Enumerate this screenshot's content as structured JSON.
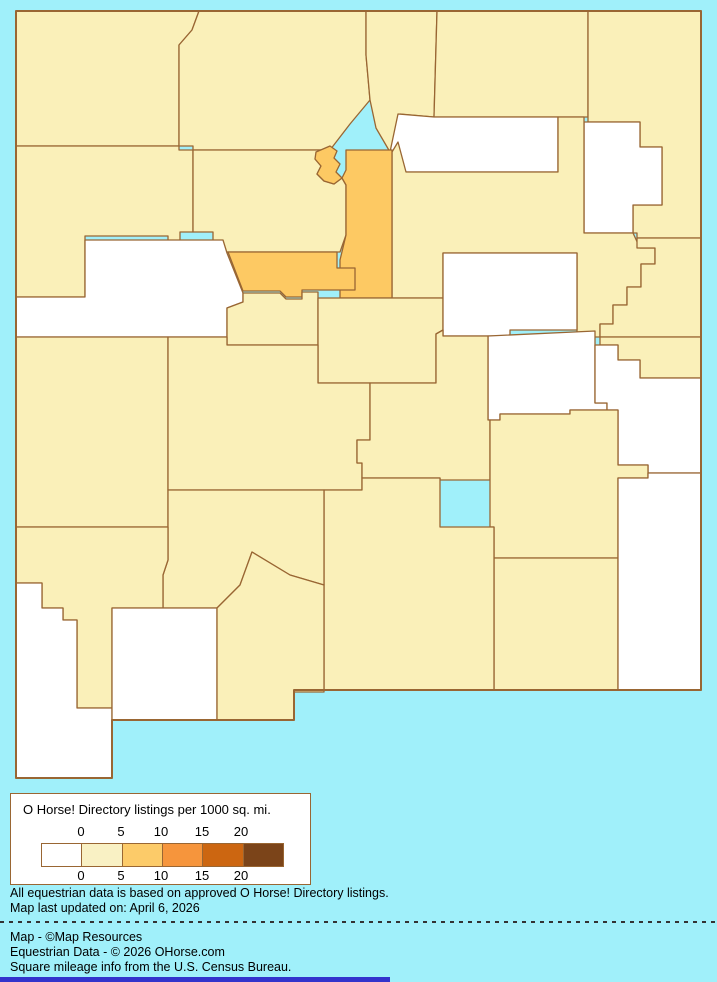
{
  "page": {
    "background_color": "#A0F0FA",
    "bottom_bar_color": "#3333CC"
  },
  "map": {
    "region": "New Mexico counties choropleth",
    "border_color": "#996633",
    "fills": {
      "white": "#FFFFFF",
      "pale": "#FAF0B9",
      "orange": "#FDC963"
    },
    "state_outline": "M16,11 L701,11 L701,690 L294,690 L294,720 L112,720 L112,778 L16,778 Z",
    "counties": [
      {
        "name": "san-juan",
        "category": "pale",
        "d": "M16,11 L199,11 L192,30 L179,45 L179,146 L16,146 Z"
      },
      {
        "name": "rio-arriba",
        "category": "pale",
        "d": "M199,11 L366,11 L366,55 L370,100 L350,124 L330,150 L193,150 L193,146 L179,146 L179,45 L192,30 Z"
      },
      {
        "name": "taos",
        "category": "pale",
        "d": "M366,11 L437,11 L434,117 L400,114 L396,142 L390,152 L376,128 L370,100 L366,55 Z"
      },
      {
        "name": "colfax",
        "category": "pale",
        "d": "M437,11 L588,11 L588,117 L434,117 Z"
      },
      {
        "name": "union",
        "category": "pale",
        "d": "M588,11 L701,11 L701,238 L637,238 L637,233 L633,233 L633,205 L662,205 L662,147 L640,147 L640,122 L588,122 Z"
      },
      {
        "name": "mora",
        "category": "white",
        "d": "M398,114 L434,117 L558,117 L558,172 L406,172 L390,152 Z"
      },
      {
        "name": "harding",
        "category": "white",
        "d": "M584,122 L640,122 L640,147 L662,147 L662,205 L633,205 L633,233 L584,233 Z"
      },
      {
        "name": "san-miguel",
        "category": "pale",
        "d": "M392,152 L398,142 L406,172 L558,172 L558,117 L584,117 L584,233 L633,233 L640,248 L655,248 L655,264 L641,264 L641,287 L627,287 L627,305 L613,305 L613,324 L600,324 L600,337 L577,337 L577,253 L443,253 L443,298 L392,298 Z"
      },
      {
        "name": "quay",
        "category": "pale",
        "d": "M637,238 L701,238 L701,337 L600,337 L600,324 L613,324 L613,305 L627,305 L627,287 L641,287 L641,264 L655,264 L655,248 L637,248 Z"
      },
      {
        "name": "mckinley",
        "category": "pale",
        "d": "M16,146 L179,146 L179,150 L193,150 L193,232 L180,232 L180,242 L168,242 L168,236 L85,236 L85,297 L16,297 Z"
      },
      {
        "name": "sandoval",
        "category": "pale",
        "d": "M193,150 L330,150 L322,157 L315,159 L321,166 L317,174 L324,181 L334,184 L342,178 L346,185 L346,235 L340,252 L213,252 L213,232 L193,232 Z"
      },
      {
        "name": "los-alamos",
        "category": "orange",
        "d": "M316,152 L330,146 L337,151 L334,158 L340,164 L336,172 L342,178 L334,184 L324,181 L317,174 L321,166 L315,159 Z"
      },
      {
        "name": "santa-fe",
        "category": "orange",
        "d": "M346,150 L392,150 L392,298 L340,298 L340,260 L346,235 L346,185 L342,178 L346,170 Z"
      },
      {
        "name": "cibola",
        "category": "white",
        "d": "M16,297 L85,297 L85,240 L223,240 L227,253 L243,293 L243,302 L227,308 L227,337 L16,337 Z"
      },
      {
        "name": "bernalillo",
        "category": "orange",
        "d": "M228,252 L337,252 L337,268 L355,268 L355,290 L302,290 L302,297 L286,297 L280,291 L243,291 Z"
      },
      {
        "name": "valencia",
        "category": "pale",
        "d": "M227,308 L243,302 L243,293 L280,293 L286,299 L302,299 L302,292 L318,292 L318,345 L227,345 Z"
      },
      {
        "name": "torrance",
        "category": "pale",
        "d": "M318,298 L443,298 L443,330 L436,334 L436,383 L318,383 Z"
      },
      {
        "name": "guadalupe",
        "category": "white",
        "d": "M443,253 L577,253 L577,330 L510,330 L510,336 L443,336 Z"
      },
      {
        "name": "de-baca",
        "category": "white",
        "d": "M488,336 L595,331 L595,403 L607,403 L607,410 L570,410 L570,414 L500,414 L500,420 L488,420 L488,405 Z"
      },
      {
        "name": "curry",
        "category": "pale",
        "d": "M600,337 L701,337 L701,378 L640,378 L640,360 L618,360 L618,345 L600,345 Z"
      },
      {
        "name": "roosevelt",
        "category": "white",
        "d": "M595,345 L618,345 L618,360 L640,360 L640,378 L701,378 L701,473 L648,473 L648,465 L618,465 L618,410 L607,410 L607,403 L595,403 Z"
      },
      {
        "name": "catron",
        "category": "pale",
        "d": "M16,337 L168,337 L168,527 L16,527 Z"
      },
      {
        "name": "socorro",
        "category": "pale",
        "d": "M168,337 L227,337 L227,345 L318,345 L318,383 L370,383 L370,440 L357,440 L357,463 L362,463 L362,490 L168,490 Z"
      },
      {
        "name": "lincoln",
        "category": "pale",
        "d": "M357,463 L357,440 L370,440 L370,383 L436,383 L436,334 L443,330 L443,336 L488,336 L488,405 L488,420 L490,420 L490,480 L440,480 L440,478 L362,478 L362,463 Z"
      },
      {
        "name": "chaves",
        "category": "pale",
        "d": "M490,420 L500,420 L500,414 L570,414 L570,410 L618,410 L618,465 L648,465 L648,478 L618,478 L618,558 L494,558 L494,527 L490,527 Z"
      },
      {
        "name": "eddy",
        "category": "pale",
        "d": "M494,558 L618,558 L618,690 L494,690 Z"
      },
      {
        "name": "lea",
        "category": "white",
        "d": "M618,478 L648,478 L648,473 L701,473 L701,690 L618,690 Z"
      },
      {
        "name": "otero",
        "category": "pale",
        "d": "M324,490 L362,490 L362,478 L440,478 L440,527 L494,527 L494,690 L324,690 Z"
      },
      {
        "name": "sierra",
        "category": "pale",
        "d": "M168,560 L168,490 L324,490 L324,585 L290,575 L252,552 L240,585 L217,608 L163,608 L163,575 Z"
      },
      {
        "name": "grant",
        "category": "pale",
        "d": "M16,527 L168,527 L168,560 L163,575 L163,608 L112,608 L112,708 L77,708 L77,620 L63,620 L63,608 L42,608 L42,583 L16,583 Z"
      },
      {
        "name": "hidalgo",
        "category": "white",
        "d": "M16,583 L42,583 L42,608 L63,608 L63,620 L77,620 L77,708 L112,708 L112,778 L16,778 Z"
      },
      {
        "name": "luna",
        "category": "white",
        "d": "M112,608 L217,608 L217,720 L112,720 Z"
      },
      {
        "name": "dona-ana",
        "category": "pale",
        "d": "M217,720 L217,608 L240,585 L252,552 L290,575 L324,585 L324,692 L294,692 L294,720 Z"
      }
    ]
  },
  "legend": {
    "title": "O Horse! Directory listings per 1000 sq. mi.",
    "tick_labels": [
      "0",
      "5",
      "10",
      "15",
      "20"
    ],
    "tick_positions_px": [
      70,
      110,
      150,
      191,
      230
    ],
    "ramp_colors": [
      "#FFFFFF",
      "#F9F1C4",
      "#FCCB69",
      "#F6953C",
      "#CC6611",
      "#7B4419"
    ],
    "border_color": "#996633"
  },
  "notes": {
    "line1": "All equestrian data is based on approved O Horse! Directory listings.",
    "line2": "Map last updated on: April 6, 2026"
  },
  "credits": {
    "line1": "Map - ©Map Resources",
    "line2": "Equestrian Data - © 2026 OHorse.com",
    "line3": "Square mileage info from the U.S. Census Bureau."
  },
  "chart_data": {
    "type": "choropleth-map",
    "title": "O Horse! Directory listings per 1000 sq. mi.",
    "legend_breaks": [
      0,
      5,
      10,
      15,
      20
    ],
    "categories": {
      "white_0": [
        "mora",
        "harding",
        "cibola",
        "guadalupe",
        "de-baca",
        "roosevelt",
        "lea",
        "hidalgo",
        "luna"
      ],
      "pale_0_5": [
        "san-juan",
        "rio-arriba",
        "taos",
        "colfax",
        "union",
        "san-miguel",
        "quay",
        "mckinley",
        "sandoval",
        "valencia",
        "torrance",
        "curry",
        "catron",
        "socorro",
        "lincoln",
        "chaves",
        "eddy",
        "otero",
        "sierra",
        "grant",
        "dona-ana"
      ],
      "orange_5_10": [
        "los-alamos",
        "santa-fe",
        "bernalillo"
      ]
    }
  }
}
